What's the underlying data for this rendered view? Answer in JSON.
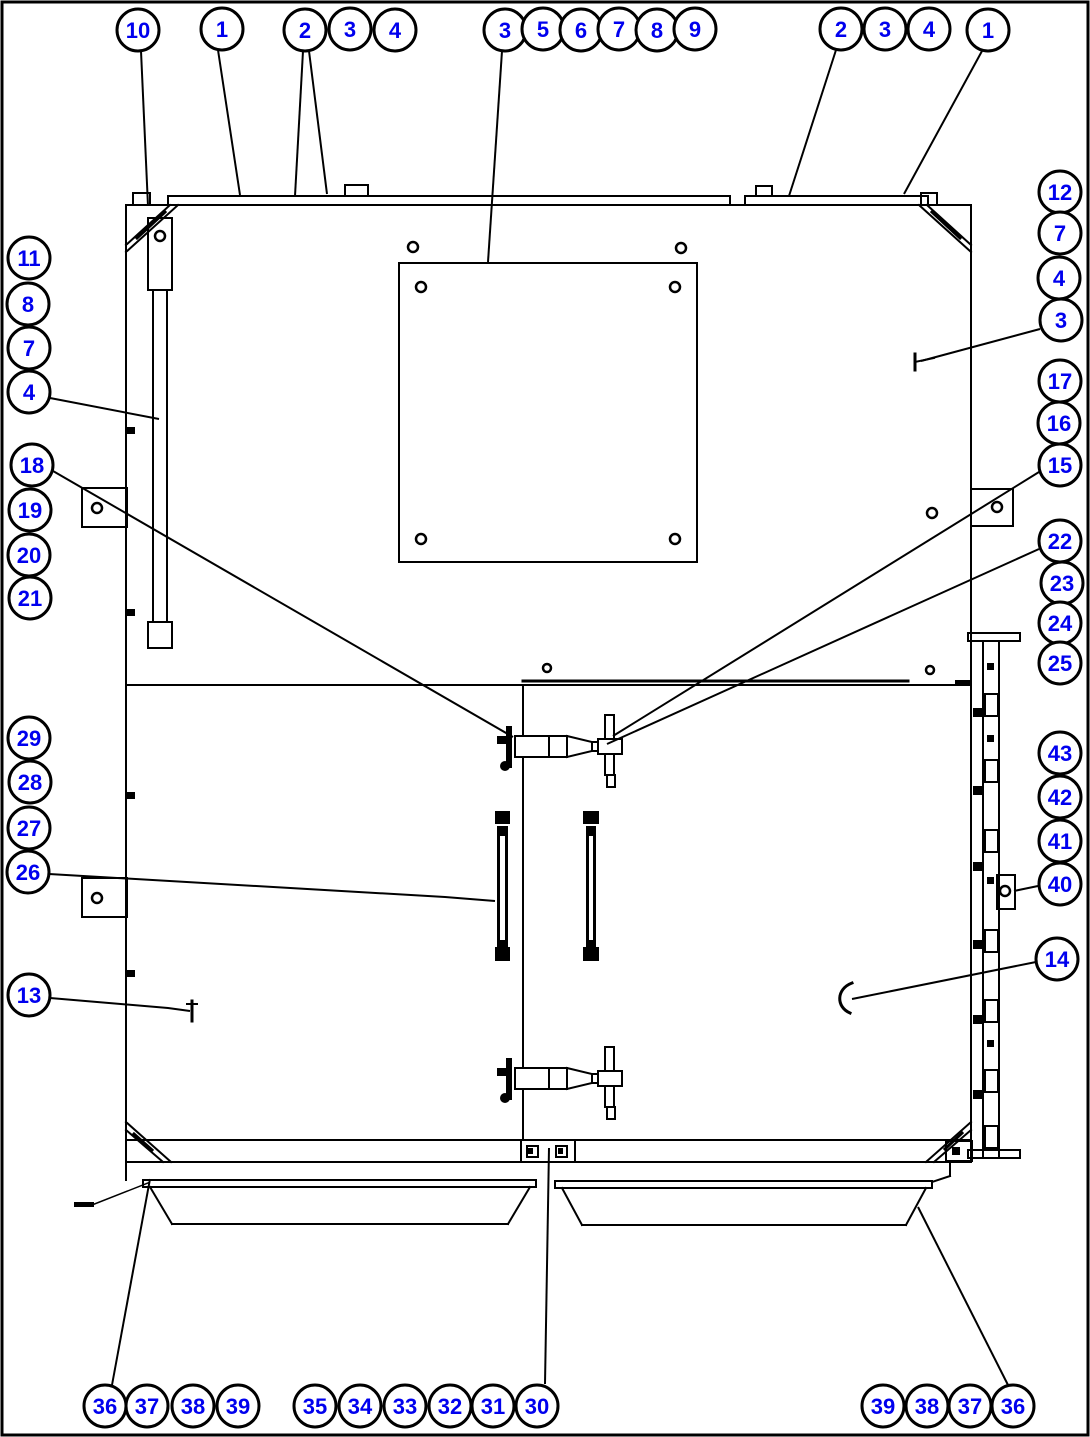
{
  "figure": {
    "type": "parts-callout-diagram",
    "background": "#ffffff",
    "border_color": "#000000",
    "line_color": "#000000",
    "balloon": {
      "fill": "#ffffff",
      "stroke": "#000000",
      "stroke_width": 3,
      "number_color": "#0000ee",
      "radius": 21
    },
    "leader_width": 2
  },
  "callouts": [
    {
      "label": "10",
      "x": 138,
      "y": 30,
      "leaders": [
        [
          [
            141,
            51
          ],
          [
            148,
            206
          ]
        ]
      ]
    },
    {
      "label": "1",
      "x": 222,
      "y": 29,
      "leaders": [
        [
          [
            218,
            50
          ],
          [
            240,
            195
          ]
        ]
      ]
    },
    {
      "label": "2",
      "x": 305,
      "y": 30,
      "leaders": [
        [
          [
            303,
            51
          ],
          [
            295,
            196
          ]
        ],
        [
          [
            309,
            51
          ],
          [
            327,
            194
          ]
        ]
      ]
    },
    {
      "label": "3",
      "x": 350,
      "y": 29
    },
    {
      "label": "4",
      "x": 395,
      "y": 30
    },
    {
      "label": "3",
      "x": 505,
      "y": 30,
      "leaders": [
        [
          [
            502,
            51
          ],
          [
            488,
            262
          ]
        ]
      ]
    },
    {
      "label": "5",
      "x": 543,
      "y": 29
    },
    {
      "label": "6",
      "x": 581,
      "y": 30
    },
    {
      "label": "7",
      "x": 619,
      "y": 29
    },
    {
      "label": "8",
      "x": 657,
      "y": 30
    },
    {
      "label": "9",
      "x": 695,
      "y": 29
    },
    {
      "label": "2",
      "x": 841,
      "y": 29,
      "leaders": [
        [
          [
            836,
            50
          ],
          [
            789,
            196
          ]
        ]
      ]
    },
    {
      "label": "3",
      "x": 885,
      "y": 29
    },
    {
      "label": "4",
      "x": 929,
      "y": 29
    },
    {
      "label": "1",
      "x": 988,
      "y": 30,
      "leaders": [
        [
          [
            982,
            51
          ],
          [
            904,
            194
          ]
        ]
      ]
    },
    {
      "label": "12",
      "x": 1060,
      "y": 192
    },
    {
      "label": "7",
      "x": 1060,
      "y": 233
    },
    {
      "label": "4",
      "x": 1059,
      "y": 278
    },
    {
      "label": "3",
      "x": 1061,
      "y": 320,
      "leaders": [
        [
          [
            1040,
            329
          ],
          [
            921,
            361
          ]
        ]
      ]
    },
    {
      "label": "17",
      "x": 1060,
      "y": 381
    },
    {
      "label": "16",
      "x": 1059,
      "y": 423
    },
    {
      "label": "15",
      "x": 1060,
      "y": 465,
      "leaders": [
        [
          [
            1039,
            472
          ],
          [
            613,
            736
          ]
        ]
      ]
    },
    {
      "label": "22",
      "x": 1060,
      "y": 541,
      "leaders": [
        [
          [
            1039,
            549
          ],
          [
            607,
            744
          ]
        ]
      ]
    },
    {
      "label": "23",
      "x": 1062,
      "y": 583
    },
    {
      "label": "24",
      "x": 1060,
      "y": 623
    },
    {
      "label": "25",
      "x": 1060,
      "y": 663
    },
    {
      "label": "43",
      "x": 1060,
      "y": 753
    },
    {
      "label": "42",
      "x": 1060,
      "y": 797
    },
    {
      "label": "41",
      "x": 1060,
      "y": 841
    },
    {
      "label": "40",
      "x": 1060,
      "y": 884,
      "leaders": [
        [
          [
            1038,
            886
          ],
          [
            1014,
            891
          ]
        ]
      ]
    },
    {
      "label": "14",
      "x": 1057,
      "y": 959,
      "leaders": [
        [
          [
            1036,
            962
          ],
          [
            852,
            999
          ]
        ]
      ]
    },
    {
      "label": "11",
      "x": 29,
      "y": 258
    },
    {
      "label": "8",
      "x": 28,
      "y": 304
    },
    {
      "label": "7",
      "x": 29,
      "y": 348
    },
    {
      "label": "4",
      "x": 29,
      "y": 392,
      "leaders": [
        [
          [
            50,
            398
          ],
          [
            159,
            419
          ]
        ]
      ]
    },
    {
      "label": "18",
      "x": 32,
      "y": 465,
      "leaders": [
        [
          [
            53,
            471
          ],
          [
            513,
            737
          ]
        ]
      ]
    },
    {
      "label": "19",
      "x": 30,
      "y": 510
    },
    {
      "label": "20",
      "x": 29,
      "y": 555
    },
    {
      "label": "21",
      "x": 30,
      "y": 598
    },
    {
      "label": "29",
      "x": 29,
      "y": 738
    },
    {
      "label": "28",
      "x": 30,
      "y": 782
    },
    {
      "label": "27",
      "x": 29,
      "y": 828
    },
    {
      "label": "26",
      "x": 28,
      "y": 872,
      "leaders": [
        [
          [
            49,
            874
          ],
          [
            445,
            897
          ],
          [
            495,
            901
          ]
        ]
      ]
    },
    {
      "label": "13",
      "x": 29,
      "y": 995,
      "leaders": [
        [
          [
            50,
            998
          ],
          [
            168,
            1008
          ],
          [
            190,
            1011
          ]
        ]
      ]
    },
    {
      "label": "36",
      "x": 105,
      "y": 1406,
      "leaders": [
        [
          [
            112,
            1385
          ],
          [
            150,
            1179
          ]
        ]
      ]
    },
    {
      "label": "37",
      "x": 147,
      "y": 1406
    },
    {
      "label": "38",
      "x": 193,
      "y": 1406
    },
    {
      "label": "39",
      "x": 238,
      "y": 1406
    },
    {
      "label": "35",
      "x": 315,
      "y": 1406
    },
    {
      "label": "34",
      "x": 360,
      "y": 1406
    },
    {
      "label": "33",
      "x": 405,
      "y": 1406
    },
    {
      "label": "32",
      "x": 450,
      "y": 1406
    },
    {
      "label": "31",
      "x": 493,
      "y": 1406
    },
    {
      "label": "30",
      "x": 537,
      "y": 1406,
      "leaders": [
        [
          [
            545,
            1384
          ],
          [
            549,
            1148
          ]
        ]
      ]
    },
    {
      "label": "39",
      "x": 883,
      "y": 1406
    },
    {
      "label": "38",
      "x": 927,
      "y": 1406
    },
    {
      "label": "37",
      "x": 970,
      "y": 1406
    },
    {
      "label": "36",
      "x": 1013,
      "y": 1406,
      "leaders": [
        [
          [
            1008,
            1385
          ],
          [
            918,
            1207
          ]
        ]
      ]
    }
  ]
}
